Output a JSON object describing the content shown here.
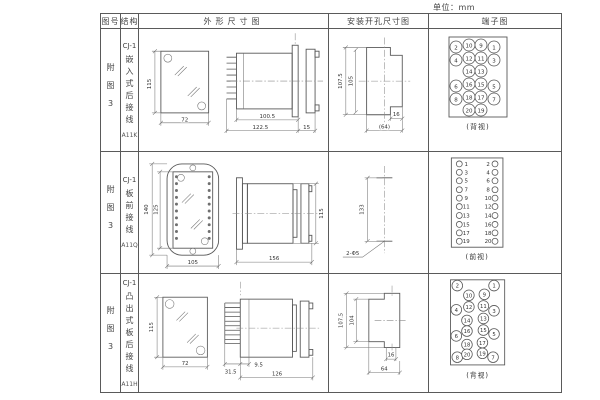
{
  "unit_label": "单位：mm",
  "headers": {
    "fig": "图号",
    "structure": "结构",
    "outline": "外形尺寸图",
    "install": "安装开孔尺寸图",
    "terminal": "端子图"
  },
  "rows": [
    {
      "fig": "附图3",
      "model": "CJ-1",
      "structure": "嵌入式后接线",
      "code": "A11K",
      "dims": {
        "front_h": "115",
        "front_w": "72",
        "body_l": "100.5",
        "total_l": "122.5",
        "flange": "15",
        "cut_outer": "107.5",
        "cut_inner": "105",
        "cut_slot": "16",
        "cut_w": "(64)"
      },
      "terminal": {
        "caption": "(背视)",
        "r": 6,
        "font": 6.5,
        "points": [
          {
            "n": "2",
            "cx": 27,
            "cy": 18
          },
          {
            "n": "10",
            "cx": 40,
            "cy": 16
          },
          {
            "n": "9",
            "cx": 52,
            "cy": 16
          },
          {
            "n": "1",
            "cx": 65,
            "cy": 18
          },
          {
            "n": "4",
            "cx": 27,
            "cy": 31
          },
          {
            "n": "12",
            "cx": 40,
            "cy": 29
          },
          {
            "n": "11",
            "cx": 52,
            "cy": 29
          },
          {
            "n": "3",
            "cx": 65,
            "cy": 31
          },
          {
            "n": "14",
            "cx": 40,
            "cy": 42
          },
          {
            "n": "13",
            "cx": 52,
            "cy": 42
          },
          {
            "n": "6",
            "cx": 27,
            "cy": 57
          },
          {
            "n": "16",
            "cx": 40,
            "cy": 55
          },
          {
            "n": "15",
            "cx": 52,
            "cy": 55
          },
          {
            "n": "5",
            "cx": 65,
            "cy": 57
          },
          {
            "n": "8",
            "cx": 27,
            "cy": 70
          },
          {
            "n": "18",
            "cx": 40,
            "cy": 68
          },
          {
            "n": "17",
            "cx": 52,
            "cy": 68
          },
          {
            "n": "7",
            "cx": 65,
            "cy": 70
          },
          {
            "n": "20",
            "cx": 40,
            "cy": 81
          },
          {
            "n": "19",
            "cx": 52,
            "cy": 81
          }
        ]
      }
    },
    {
      "fig": "附图3",
      "model": "CJ-1",
      "structure": "板前接线",
      "code": "A11Q",
      "dims": {
        "front_h": "140",
        "front_inner_h": "125",
        "front_w": "105",
        "total_l": "156",
        "body_h": "115",
        "hole_dist": "133",
        "hole_label": "2-Φ5"
      },
      "terminal": {
        "caption": "(前视)",
        "r": 3,
        "font": 5,
        "points": [
          {
            "n": "1",
            "cx": 30,
            "cy": 12,
            "tx": 37,
            "ty": 14
          },
          {
            "n": "2",
            "cx": 66,
            "cy": 12,
            "tx": 59,
            "ty": 14
          },
          {
            "n": "3",
            "cx": 30,
            "cy": 20.5,
            "tx": 37,
            "ty": 22.5
          },
          {
            "n": "4",
            "cx": 66,
            "cy": 20.5,
            "tx": 59,
            "ty": 22.5
          },
          {
            "n": "5",
            "cx": 30,
            "cy": 29,
            "tx": 37,
            "ty": 31
          },
          {
            "n": "6",
            "cx": 66,
            "cy": 29,
            "tx": 59,
            "ty": 31
          },
          {
            "n": "7",
            "cx": 30,
            "cy": 38,
            "tx": 37,
            "ty": 40
          },
          {
            "n": "8",
            "cx": 66,
            "cy": 38,
            "tx": 59,
            "ty": 40
          },
          {
            "n": "9",
            "cx": 30,
            "cy": 46.5,
            "tx": 37,
            "ty": 48.5
          },
          {
            "n": "10",
            "cx": 66,
            "cy": 46.5,
            "tx": 59,
            "ty": 48.5
          },
          {
            "n": "11",
            "cx": 30,
            "cy": 55,
            "tx": 37,
            "ty": 57
          },
          {
            "n": "12",
            "cx": 66,
            "cy": 55,
            "tx": 59,
            "ty": 57
          },
          {
            "n": "13",
            "cx": 30,
            "cy": 64,
            "tx": 37,
            "ty": 66
          },
          {
            "n": "14",
            "cx": 66,
            "cy": 64,
            "tx": 59,
            "ty": 66
          },
          {
            "n": "15",
            "cx": 30,
            "cy": 73,
            "tx": 37,
            "ty": 75
          },
          {
            "n": "16",
            "cx": 66,
            "cy": 73,
            "tx": 59,
            "ty": 75
          },
          {
            "n": "17",
            "cx": 30,
            "cy": 81.5,
            "tx": 37,
            "ty": 83.5
          },
          {
            "n": "18",
            "cx": 66,
            "cy": 81.5,
            "tx": 59,
            "ty": 83.5
          },
          {
            "n": "19",
            "cx": 30,
            "cy": 90,
            "tx": 37,
            "ty": 92
          },
          {
            "n": "20",
            "cx": 66,
            "cy": 90,
            "tx": 59,
            "ty": 92
          }
        ]
      }
    },
    {
      "fig": "附图3",
      "model": "CJ-1",
      "structure": "凸出式板后接线",
      "code": "A11H",
      "dims": {
        "front_h": "115",
        "front_w": "72",
        "pin_l": "31.5",
        "step": "9.5",
        "body_l": "126",
        "cut_outer": "107.5",
        "cut_inner": "104",
        "cut_slot": "16",
        "cut_w": "64"
      },
      "terminal": {
        "caption": "(背视)",
        "r": 5.5,
        "font": 6,
        "points": [
          {
            "n": "2",
            "cx": 27,
            "cy": 12
          },
          {
            "n": "1",
            "cx": 65,
            "cy": 12
          },
          {
            "n": "10",
            "cx": 39,
            "cy": 22
          },
          {
            "n": "9",
            "cx": 55,
            "cy": 21
          },
          {
            "n": "4",
            "cx": 26,
            "cy": 37
          },
          {
            "n": "12",
            "cx": 39,
            "cy": 34
          },
          {
            "n": "11",
            "cx": 54,
            "cy": 33
          },
          {
            "n": "3",
            "cx": 65,
            "cy": 38
          },
          {
            "n": "14",
            "cx": 37,
            "cy": 48
          },
          {
            "n": "13",
            "cx": 54,
            "cy": 46
          },
          {
            "n": "6",
            "cx": 26,
            "cy": 64
          },
          {
            "n": "16",
            "cx": 37,
            "cy": 59
          },
          {
            "n": "15",
            "cx": 54,
            "cy": 58
          },
          {
            "n": "5",
            "cx": 65,
            "cy": 62
          },
          {
            "n": "18",
            "cx": 37,
            "cy": 73
          },
          {
            "n": "17",
            "cx": 53,
            "cy": 71
          },
          {
            "n": "8",
            "cx": 27,
            "cy": 86
          },
          {
            "n": "20",
            "cx": 37,
            "cy": 83
          },
          {
            "n": "19",
            "cx": 53,
            "cy": 82
          },
          {
            "n": "7",
            "cx": 64,
            "cy": 86
          }
        ]
      }
    }
  ]
}
